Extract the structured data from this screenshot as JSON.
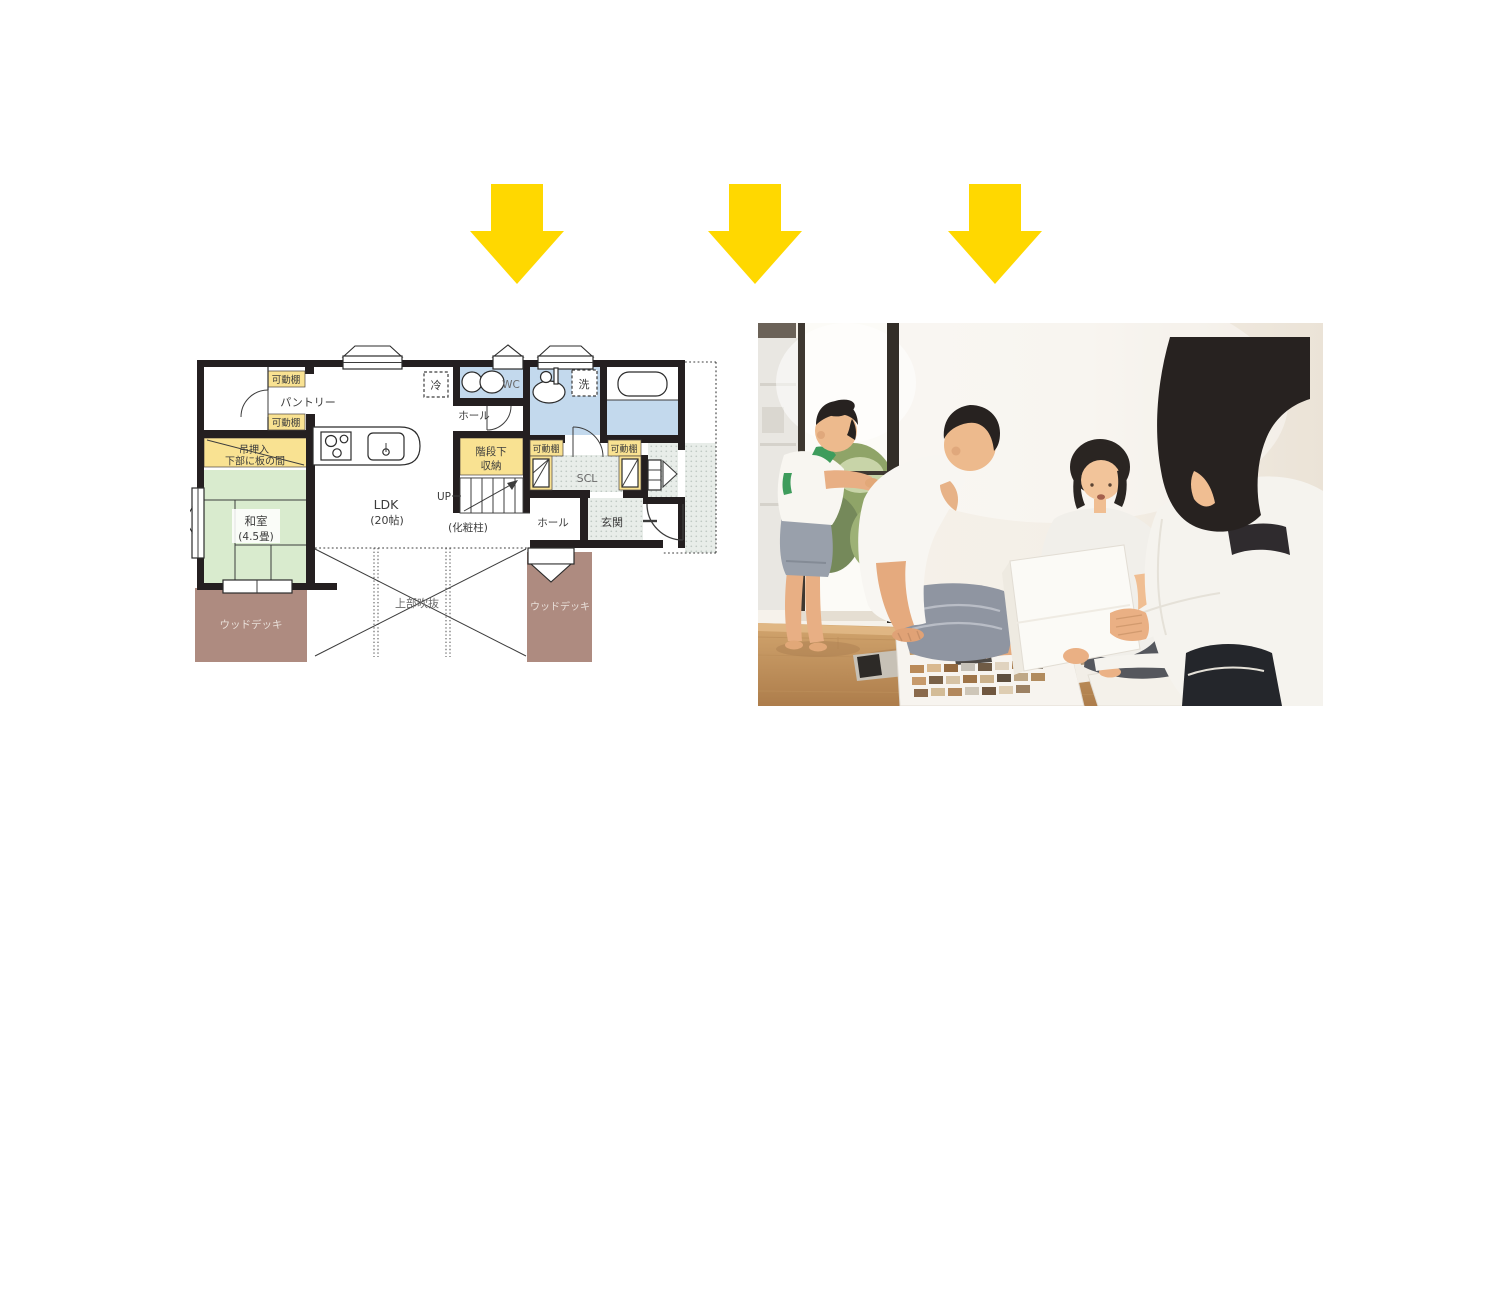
{
  "css_vars": {
    "arrow": "#FFD800",
    "wall": "#241F20",
    "shelf": "#F9E292",
    "tatami": "#D9EBCE",
    "wet": "#C3D9ED",
    "deck": "#AE8B80",
    "ptext": "#3C3C3C"
  },
  "arrows": {
    "count": 3,
    "color": "#FFD800"
  },
  "floorplan": {
    "colors": {
      "wall_black": "#241F20",
      "shelf_yellow": "#F9E292",
      "tatami_green": "#D9EBCE",
      "wet_area_blue": "#C3D9ED",
      "deck_brown": "#AE8B80",
      "entry_dot_gray": "#E8EDE9"
    },
    "labels": {
      "movable_shelf": "可動棚",
      "pantry": "パントリー",
      "hanging_closet_line1": "吊押入",
      "hanging_closet_line2": "下部に板の間",
      "tatami_room": "和室",
      "tatami_size": "(4.5畳)",
      "wood_deck": "ウッドデッキ",
      "ldk": "LDK",
      "ldk_size": "(20帖)",
      "fridge": "冷",
      "wc": "WC",
      "laundry": "洗",
      "hall": "ホール",
      "under_stairs_line1": "階段下",
      "under_stairs_line2": "収納",
      "up": "UP",
      "pillar": "(化粧柱)",
      "scl": "SCL",
      "entrance": "玄関",
      "void_above": "上部吹抜"
    }
  },
  "photo": {
    "colors": {
      "wall": "#F3EEE6",
      "floor_wood": "#CDA06A",
      "window_greenery": "#87A061",
      "hair_black": "#272220",
      "skin": "#ECB98D",
      "white_shirt": "#F6F4EF",
      "green_trim": "#3E9C5C",
      "dark_pants": "#24262B"
    }
  }
}
